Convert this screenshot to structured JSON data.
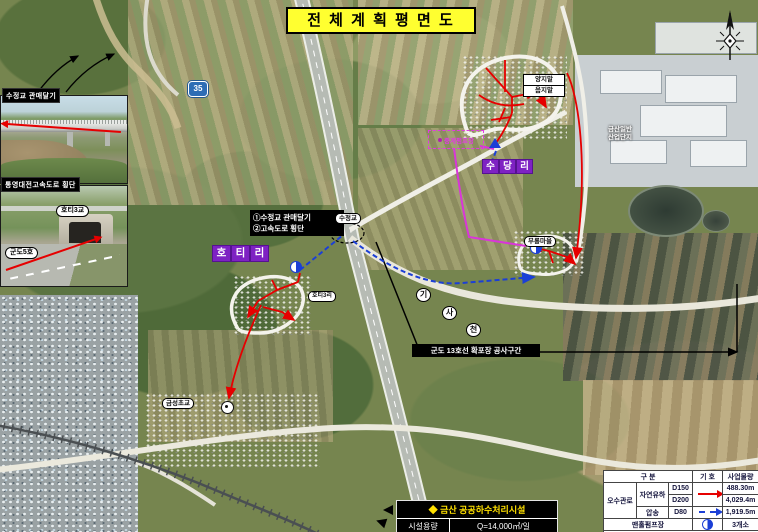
{
  "title": "전 체 계 획 평 면 도",
  "insets": {
    "photo1_label": "수정교 관매달기",
    "photo2_label": "통영대전고속도로 횡단",
    "photo2_tag_bridge": "호티3교",
    "photo2_tag_road": "군도5호"
  },
  "map": {
    "note_box_line1": "①수정교 관매달기",
    "note_box_line2": "②고속도로 횡단",
    "village_hoti": [
      "호",
      "티",
      "리"
    ],
    "village_sudang": [
      "수",
      "당",
      "리"
    ],
    "label_sujeonggyo": "수정교",
    "label_hoti3ri": "호티3리",
    "label_yangjimal": "양지말",
    "label_eumjimal": "음지말",
    "label_murong": "무롱마을",
    "label_pump": "중계펌프장",
    "label_geumseong": "금성초교",
    "stream_chars": [
      "기",
      "사",
      "천"
    ],
    "construction_label": "군도 13호선 확포장 공사구간",
    "route_shield": "35",
    "industrial_line1": "금산일반",
    "industrial_line2": "산업단지"
  },
  "facility": {
    "title": "◆ 금산 공공하수처리시설",
    "capacity_label": "시설용량",
    "capacity_value": "Q=14,000㎥/일"
  },
  "legend": {
    "header_category": "구 분",
    "header_symbol": "기 호",
    "header_quantity": "사업물량",
    "group_sewer": "오수관로",
    "type_gravity": "자연유하",
    "type_pressure": "압송",
    "d150": "D150",
    "d200": "D200",
    "d80": "D80",
    "qty_d150": "488.30m",
    "qty_d200": "4,029.4m",
    "qty_d80": "1,919.5m",
    "pump_label": "맨홀펌프장",
    "pump_qty": "3개소"
  },
  "colors": {
    "pipe_red": "#e60000",
    "pipe_blue": "#1b3fd6",
    "pipe_magenta": "#d935d9",
    "village_purple": "#7e22c3",
    "title_yellow": "#ffff30"
  }
}
